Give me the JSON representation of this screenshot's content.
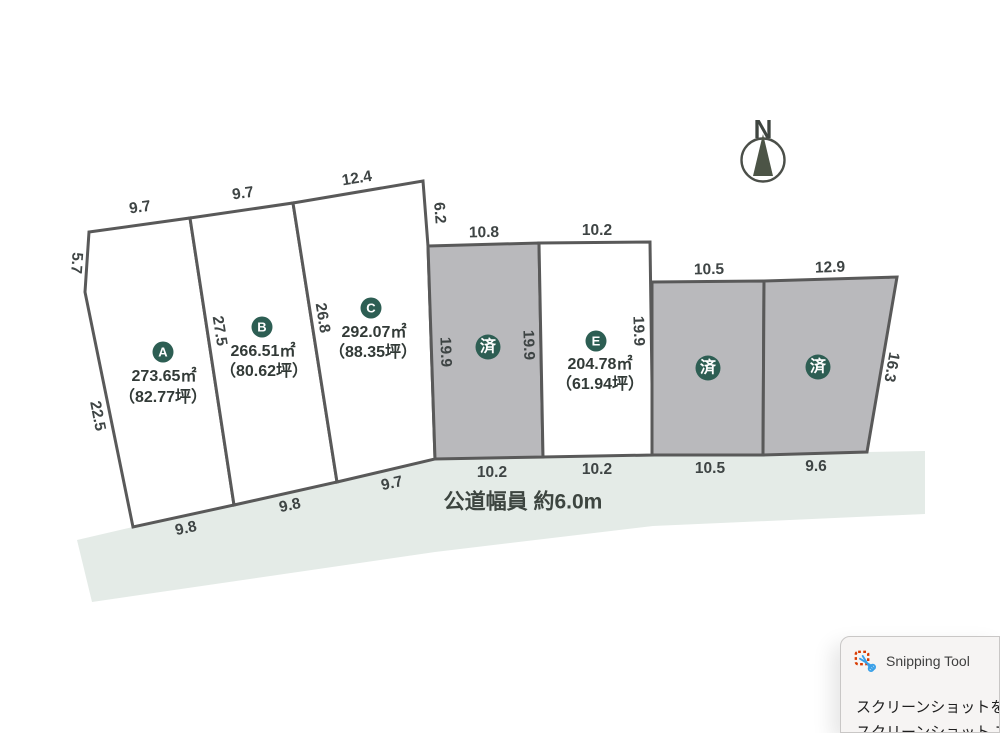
{
  "compass": {
    "label": "N"
  },
  "road": {
    "label": "公道幅員 約6.0m"
  },
  "plots": [
    {
      "name": "A",
      "badge": "A",
      "area": "273.65㎡",
      "tsubo": "（82.77坪）",
      "sold": false
    },
    {
      "name": "B",
      "badge": "B",
      "area": "266.51㎡",
      "tsubo": "（80.62坪）",
      "sold": false
    },
    {
      "name": "C",
      "badge": "C",
      "area": "292.07㎡",
      "tsubo": "（88.35坪）",
      "sold": false
    },
    {
      "name": "D",
      "badge": "済",
      "sold": true
    },
    {
      "name": "E",
      "badge": "E",
      "area": "204.78㎡",
      "tsubo": "（61.94坪）",
      "sold": false
    },
    {
      "name": "F",
      "badge": "済",
      "sold": true
    },
    {
      "name": "G",
      "badge": "済",
      "sold": true
    }
  ],
  "dimensions": {
    "a_top": "9.7",
    "b_top": "9.7",
    "c_top": "12.4",
    "c_right_upper": "6.2",
    "d_top": "10.8",
    "e_top": "10.2",
    "f_top": "10.5",
    "g_top": "12.9",
    "g_right": "16.3",
    "a_left_upper": "5.7",
    "a_left_lower": "22.5",
    "ab_divider": "27.5",
    "bc_divider": "26.8",
    "d_left": "19.9",
    "d_right": "19.9",
    "e_right": "19.9",
    "a_bottom": "9.8",
    "b_bottom": "9.8",
    "c_bottom": "9.7",
    "d_bottom": "10.2",
    "e_bottom": "10.2",
    "f_bottom": "10.5",
    "g_bottom": "9.6"
  },
  "toast": {
    "app_name": "Snipping Tool",
    "message_line1": "スクリーンショットをク",
    "message_line2": "スクリーンショット フ"
  },
  "colors": {
    "badge_green": "#2d5e53",
    "sold_gray": "#b9b9bc",
    "road_green": "#e4ebe7",
    "border_gray": "#595959",
    "dim_text": "#3e4444",
    "toast_accent_red": "#d83b01",
    "toast_accent_blue": "#3aa0e8"
  }
}
